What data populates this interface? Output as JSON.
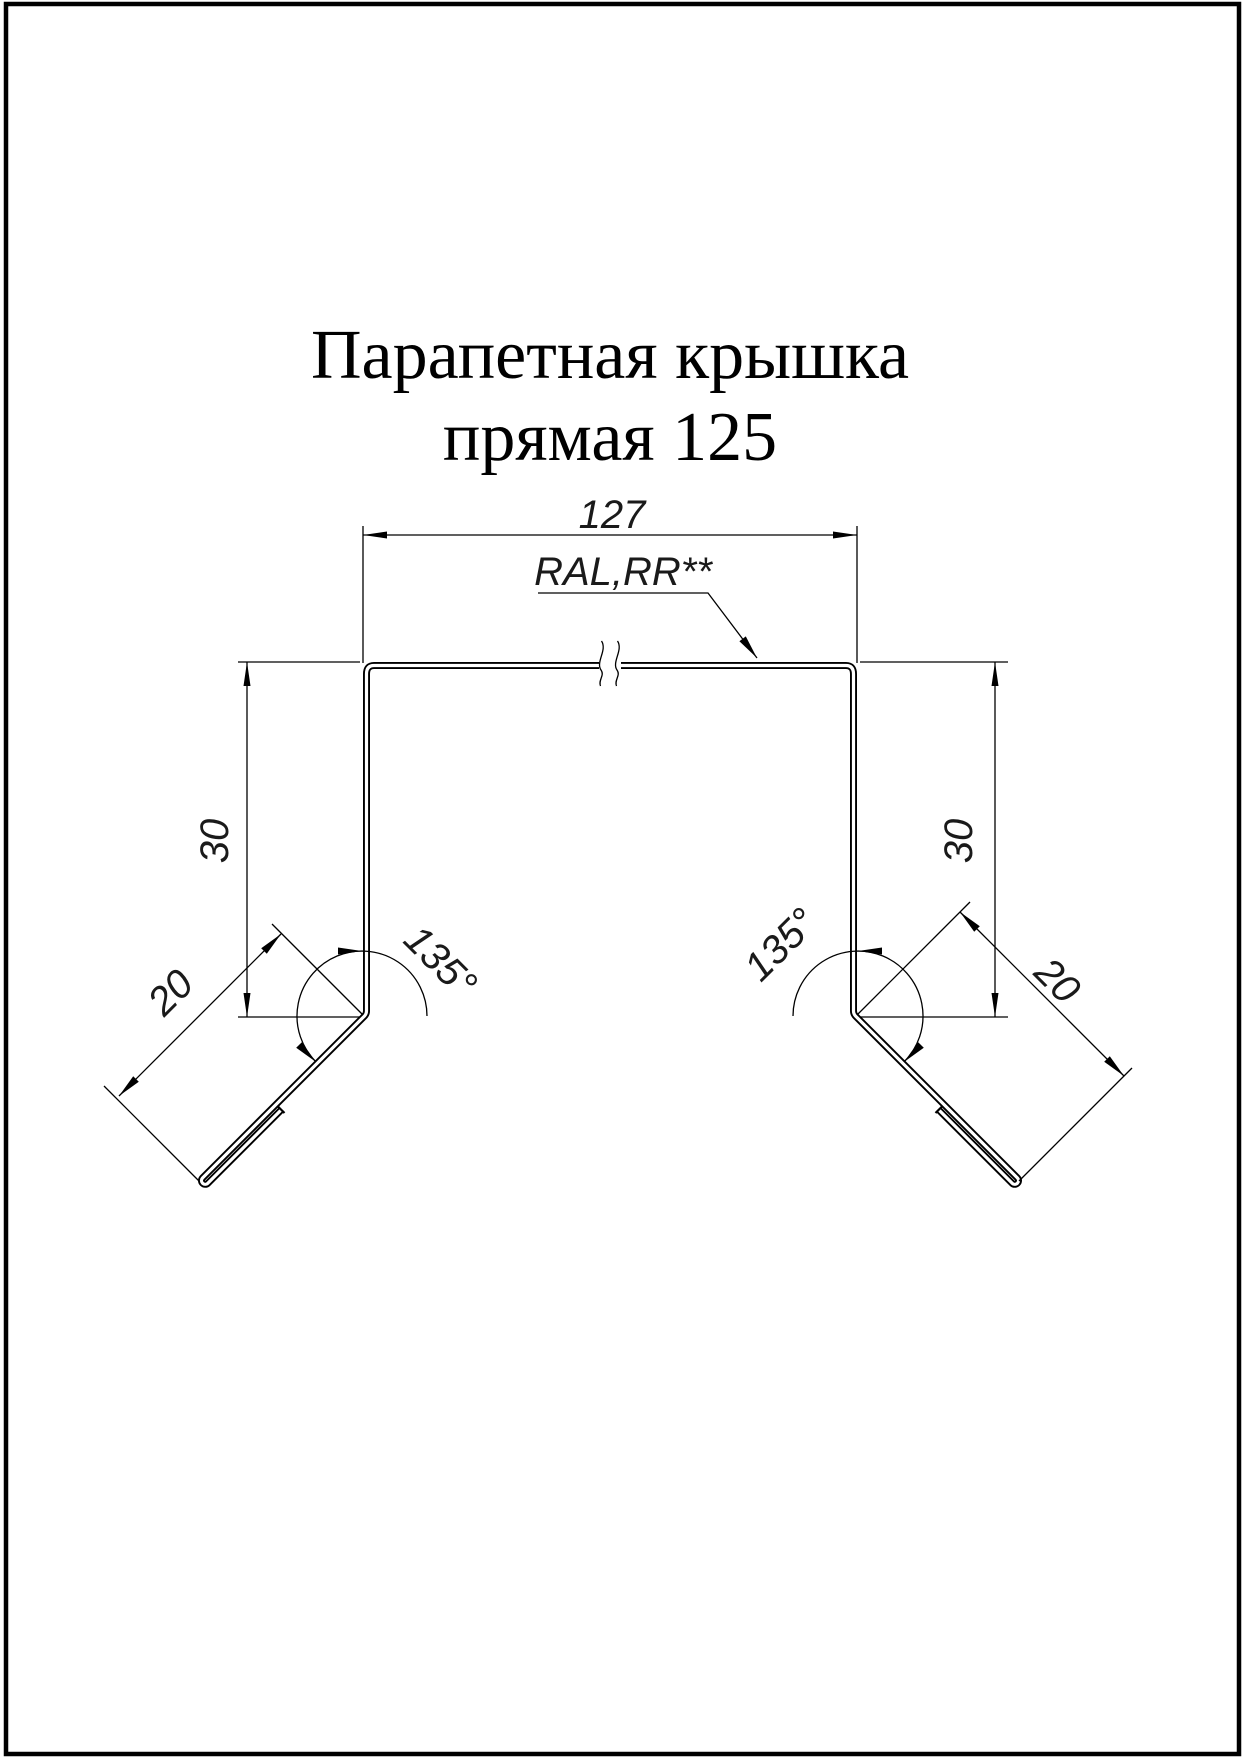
{
  "title": {
    "line1": "Парапетная крышка",
    "line2": "прямая 125"
  },
  "labels": {
    "width": "127",
    "material": "RAL,RR**",
    "height_left": "30",
    "height_right": "30",
    "flange_left": "20",
    "flange_right": "20",
    "angle_left": "135°",
    "angle_right": "135°"
  },
  "dimensions": {
    "top_width_mm": "127",
    "side_height_mm": "30",
    "flange_length_mm": "20",
    "bend_angle_deg": "135",
    "coating": "RAL,RR**"
  },
  "colors": {
    "ink": "#000000",
    "paper": "#ffffff"
  }
}
